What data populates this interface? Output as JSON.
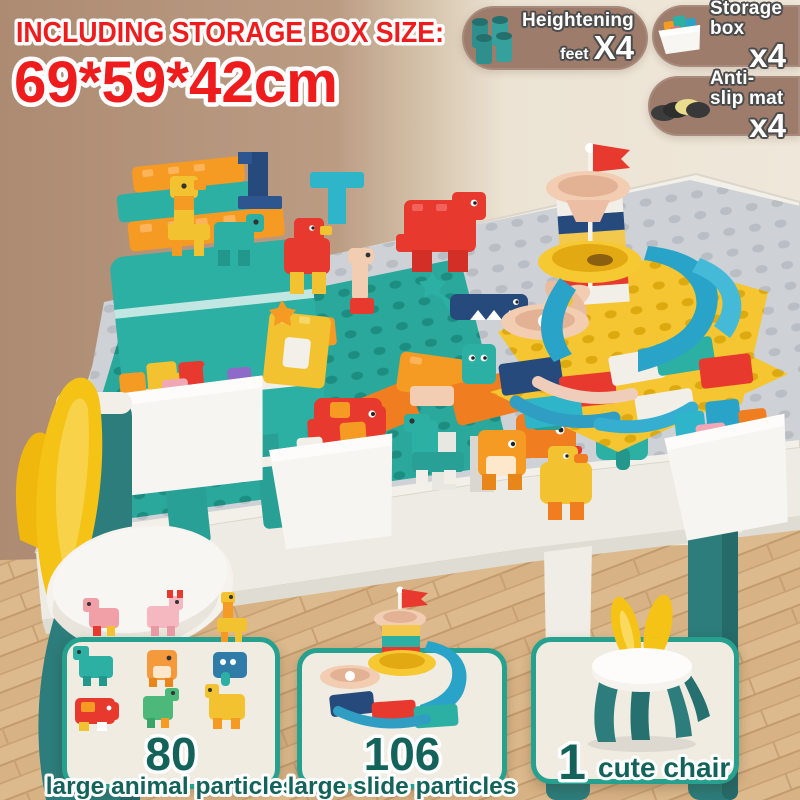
{
  "header": {
    "title_line1": "INCLUDING STORAGE BOX SIZE:",
    "title_line2": "69*59*42cm"
  },
  "badges": [
    {
      "label_top": "Heightening",
      "label_bottom": "feet",
      "count": "X4",
      "icon": "heightening-feet-icon"
    },
    {
      "label_top": "Storage box",
      "count": "x4",
      "icon": "storage-box-icon"
    },
    {
      "label_top": "Anti-slip mat",
      "count": "x4",
      "icon": "anti-slip-mat-icon"
    }
  ],
  "cards": [
    {
      "count": "80",
      "label": "large animal particles",
      "icon": "animal-figures-art"
    },
    {
      "count": "106",
      "label": "large slide particles",
      "icon": "marble-slide-art"
    },
    {
      "count": "1",
      "label": "cute chair",
      "icon": "bunny-chair-art"
    }
  ],
  "colors": {
    "title_red": "#ee1c1c",
    "badge_bg": "#9d7c6b",
    "card_border": "#27a18f",
    "card_text": "#14635a",
    "wall_left": "#b2917a",
    "wall_right": "#ece3d4",
    "floor_wood": "#ddb88b",
    "table_white": "#f3f0ea",
    "leg_teal": "#2c7d7b",
    "baseplate_teal": "#2aa89c",
    "baseplate_gray": "#ced2d6",
    "baseplate_yellow": "#f5c632"
  }
}
